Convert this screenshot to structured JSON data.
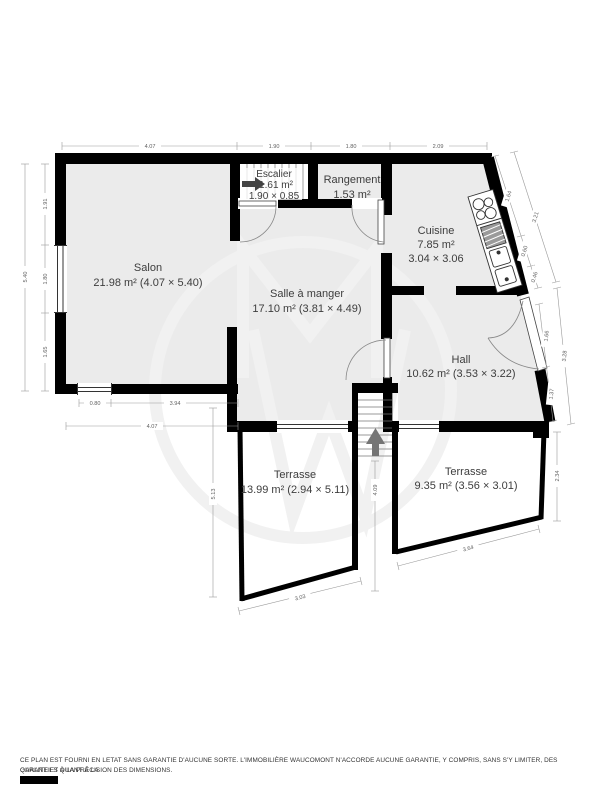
{
  "plan": {
    "rooms": {
      "salon": {
        "name": "Salon",
        "area": "21.98 m² (4.07 × 5.40)"
      },
      "salle_a_manger": {
        "name": "Salle à manger",
        "area": "17.10 m² (3.81 × 4.49)"
      },
      "escalier": {
        "name": "Escalier",
        "area": "1.61 m²",
        "size": "1.90 × 0.85"
      },
      "rangement": {
        "name": "Rangement",
        "area": "1.53 m²"
      },
      "cuisine": {
        "name": "Cuisine",
        "area": "7.85 m²",
        "size": "3.04 × 3.06"
      },
      "hall": {
        "name": "Hall",
        "area": "10.62 m² (3.53 × 3.22)"
      },
      "terrasse_gauche": {
        "name": "Terrasse",
        "area": "13.99 m² (2.94 × 5.11)"
      },
      "terrasse_droite": {
        "name": "Terrasse",
        "area": "9.35 m² (3.56 × 3.01)"
      }
    },
    "dims": {
      "top_salon": "4.07",
      "top_escalier": "1.90",
      "top_rangement": "1.80",
      "top_cuisine": "2.09",
      "left_seg1": "1.91",
      "left_seg2": "1.80",
      "left_seg3": "1.65",
      "left_total": "5.40",
      "salon_window": "0.80",
      "salon_rest": "3.94",
      "salon_total": "4.07",
      "kitchen_seg1": "1.64",
      "kitchen_seg2": "0.60",
      "kitchen_seg3": "0.46",
      "kitchen_total": "3.21",
      "hall_seg1": "1.66",
      "hall_seg2": "1.37",
      "hall_total": "3.28",
      "terrace_left_h": "5.13",
      "terrace_left_w": "3.03",
      "stairs_len": "4.09",
      "terrace_right_h": "2.34",
      "terrace_right_w": "3.64"
    },
    "icons": {
      "watermark": "mw-monogram-circle",
      "escalier_arrow": "arrow-right",
      "stairs_arrow": "arrow-up",
      "kitchen_fixture": "stove-sink-counter"
    }
  },
  "colors": {
    "wall": "#000000",
    "room_fill": "#ebebeb",
    "terrace_fill": "#ffffff",
    "label_text": "#3d3d3d",
    "dim_text": "#5f5f5f",
    "watermark": "#f1f1f1"
  },
  "footer": {
    "disclaimer_line1": "CE PLAN EST FOURNI EN LETAT SANS GARANTIE D'AUCUNE SORTE. L'IMMOBILIÈRE WAUCOMONT N'ACCORDE AUCUNE GARANTIE, Y COMPRIS, SANS S'Y LIMITER, DES GARANTIES QUANT À LA",
    "disclaimer_line2": "QUALITE ET À LA PRÉCISION DES DIMENSIONS."
  }
}
